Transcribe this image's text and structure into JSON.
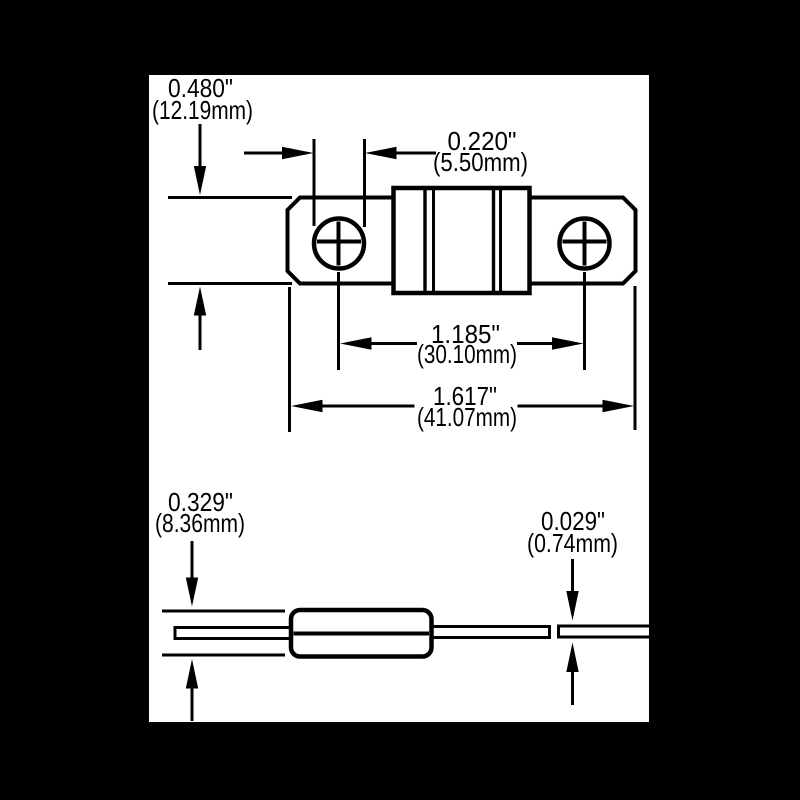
{
  "drawing": {
    "kind": "fuse-dimensional-drawing",
    "views": {
      "top": "fuse-top-view",
      "side": "fuse-side-view"
    }
  },
  "dimensions": {
    "plate_height": {
      "inch": "0.480\"",
      "mm": "(12.19mm)"
    },
    "hole_diameter": {
      "inch": "0.220\"",
      "mm": "(5.50mm)"
    },
    "hole_spacing": {
      "inch": "1.185\"",
      "mm": "(30.10mm)"
    },
    "overall_length": {
      "inch": "1.617\"",
      "mm": "(41.07mm)"
    },
    "body_height": {
      "inch": "0.329\"",
      "mm": "(8.36mm)"
    },
    "terminal_thickness": {
      "inch": "0.029\"",
      "mm": "(0.74mm)"
    }
  },
  "colors": {
    "backdrop": "#000000",
    "paper": "#ffffff",
    "ink": "#000000"
  }
}
